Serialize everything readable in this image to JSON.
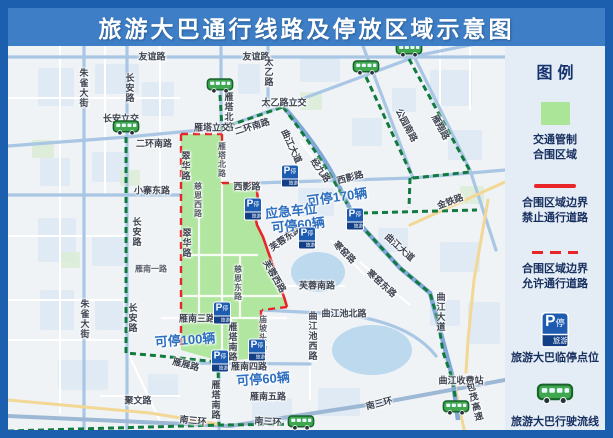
{
  "title": "旅游大巴通行线路及停放区域示意图",
  "legend": {
    "title": "图例",
    "items": [
      {
        "type": "zone-swatch",
        "line1": "交通管制",
        "line2": "合围区域"
      },
      {
        "type": "line-solid",
        "line1": "合围区域边界",
        "line2": "禁止通行道路"
      },
      {
        "type": "line-dashed",
        "line1": "合围区域边界",
        "line2": "允许通行道路"
      },
      {
        "type": "parking-icon",
        "line1": "旅游大巴临停点位"
      },
      {
        "type": "bus-icon",
        "line1": "旅游大巴行驶流线"
      }
    ]
  },
  "map": {
    "parking_icon": {
      "p": "P",
      "sub": "停",
      "band": "旅游大巴"
    },
    "street_labels": [
      {
        "t": "友谊路",
        "x": 152,
        "y": 56
      },
      {
        "t": "友谊路",
        "x": 256,
        "y": 56
      },
      {
        "t": "朱雀大街",
        "x": 84,
        "y": 88,
        "v": 1
      },
      {
        "t": "朱雀大街",
        "x": 85,
        "y": 319,
        "v": 1
      },
      {
        "t": "长安路",
        "x": 130,
        "y": 88,
        "v": 1
      },
      {
        "t": "长安路",
        "x": 137,
        "y": 232,
        "v": 1
      },
      {
        "t": "长安路",
        "x": 133,
        "y": 318,
        "v": 1
      },
      {
        "t": "长安立交",
        "x": 121,
        "y": 118
      },
      {
        "t": "二环南路",
        "x": 154,
        "y": 143
      },
      {
        "t": "二环南路",
        "x": 252,
        "y": 126,
        "r": -17
      },
      {
        "t": "小寨东路",
        "x": 152,
        "y": 190
      },
      {
        "t": "太乙路",
        "x": 269,
        "y": 72,
        "v": 1
      },
      {
        "t": "太乙路立交",
        "x": 284,
        "y": 102
      },
      {
        "t": "雁塔北路",
        "x": 229,
        "y": 112,
        "v": 1
      },
      {
        "t": "雁塔立交",
        "x": 212,
        "y": 127
      },
      {
        "t": "雁塔北路",
        "x": 222,
        "y": 160,
        "v": 1,
        "s": 1
      },
      {
        "t": "翠华路",
        "x": 186,
        "y": 166,
        "v": 1
      },
      {
        "t": "翠华路",
        "x": 187,
        "y": 243,
        "v": 1
      },
      {
        "t": "慈恩西路",
        "x": 198,
        "y": 200,
        "v": 1,
        "s": 1
      },
      {
        "t": "西影路",
        "x": 247,
        "y": 186
      },
      {
        "t": "西影路",
        "x": 350,
        "y": 177,
        "r": -15
      },
      {
        "t": "芙蓉东路",
        "x": 285,
        "y": 238,
        "r": -35
      },
      {
        "t": "芙蓉西路",
        "x": 275,
        "y": 276,
        "r": 60
      },
      {
        "t": "芙蓉南路",
        "x": 317,
        "y": 285
      },
      {
        "t": "慈恩东路",
        "x": 238,
        "y": 283,
        "v": 1,
        "s": 1
      },
      {
        "t": "雁南一路",
        "x": 151,
        "y": 269,
        "s": 1
      },
      {
        "t": "雁南三路",
        "x": 197,
        "y": 318
      },
      {
        "t": "雁展路",
        "x": 186,
        "y": 364,
        "r": 14
      },
      {
        "t": "雁塔南路",
        "x": 233,
        "y": 342,
        "v": 1
      },
      {
        "t": "雁塔南路",
        "x": 216,
        "y": 400,
        "v": 1
      },
      {
        "t": "庙坡头路",
        "x": 263,
        "y": 333,
        "v": 1,
        "s": 1
      },
      {
        "t": "雁南四路",
        "x": 249,
        "y": 366
      },
      {
        "t": "雁南五路",
        "x": 268,
        "y": 396
      },
      {
        "t": "南三环",
        "x": 193,
        "y": 420,
        "r": 6
      },
      {
        "t": "南三环",
        "x": 268,
        "y": 421,
        "r": 4
      },
      {
        "t": "南三环",
        "x": 379,
        "y": 403,
        "r": -14
      },
      {
        "t": "聚文路",
        "x": 138,
        "y": 400
      },
      {
        "t": "曲江池北路",
        "x": 344,
        "y": 313
      },
      {
        "t": "曲江池西路",
        "x": 313,
        "y": 336,
        "v": 1
      },
      {
        "t": "曲江大道",
        "x": 292,
        "y": 146,
        "r": 65
      },
      {
        "t": "曲江大道",
        "x": 400,
        "y": 247,
        "r": 42
      },
      {
        "t": "曲江大道",
        "x": 441,
        "y": 312,
        "v": 1
      },
      {
        "t": "曲江收费站",
        "x": 461,
        "y": 380
      },
      {
        "t": "包茂高速",
        "x": 475,
        "y": 402,
        "v": 1,
        "r": -15
      },
      {
        "t": "金铁路",
        "x": 450,
        "y": 201,
        "r": -20
      },
      {
        "t": "经九路",
        "x": 321,
        "y": 170,
        "r": 55
      },
      {
        "t": "公园南路",
        "x": 407,
        "y": 125,
        "r": 62
      },
      {
        "t": "雁翔路",
        "x": 441,
        "y": 127,
        "r": 62
      },
      {
        "t": "寒窑路",
        "x": 345,
        "y": 252,
        "r": 45
      },
      {
        "t": "寒窑东路",
        "x": 382,
        "y": 283,
        "r": 42
      }
    ],
    "callouts": [
      {
        "t": "可停170辆",
        "x": 337,
        "y": 196,
        "r": -8
      },
      {
        "t": "应急车位",
        "x": 291,
        "y": 210,
        "r": -6
      },
      {
        "t": "可停60辆",
        "x": 298,
        "y": 224,
        "r": -6
      },
      {
        "t": "可停100辆",
        "x": 185,
        "y": 339,
        "r": -4
      },
      {
        "t": "可停60辆",
        "x": 263,
        "y": 378,
        "r": -4
      }
    ],
    "parking_stops": [
      {
        "x": 253,
        "y": 209
      },
      {
        "x": 290,
        "y": 176
      },
      {
        "x": 355,
        "y": 219
      },
      {
        "x": 307,
        "y": 238
      },
      {
        "x": 222,
        "y": 313
      },
      {
        "x": 220,
        "y": 361
      },
      {
        "x": 257,
        "y": 350
      }
    ],
    "bus_markers": [
      {
        "x": 126,
        "y": 130
      },
      {
        "x": 220,
        "y": 88
      },
      {
        "x": 366,
        "y": 70
      },
      {
        "x": 409,
        "y": 52
      },
      {
        "x": 301,
        "y": 425
      },
      {
        "x": 456,
        "y": 410
      }
    ]
  },
  "colors": {
    "frame": "#1c5fae",
    "title_bar": "#3d7ec6",
    "legend_bg": "#e4ecf6",
    "control_zone_green": "#abe598",
    "boundary_red": "#e8262a",
    "route_green": "#117a3e",
    "bus_green": "#3fa74e",
    "parking_blue": "#1d5cb0",
    "callout_blue": "#2e6fc0"
  }
}
